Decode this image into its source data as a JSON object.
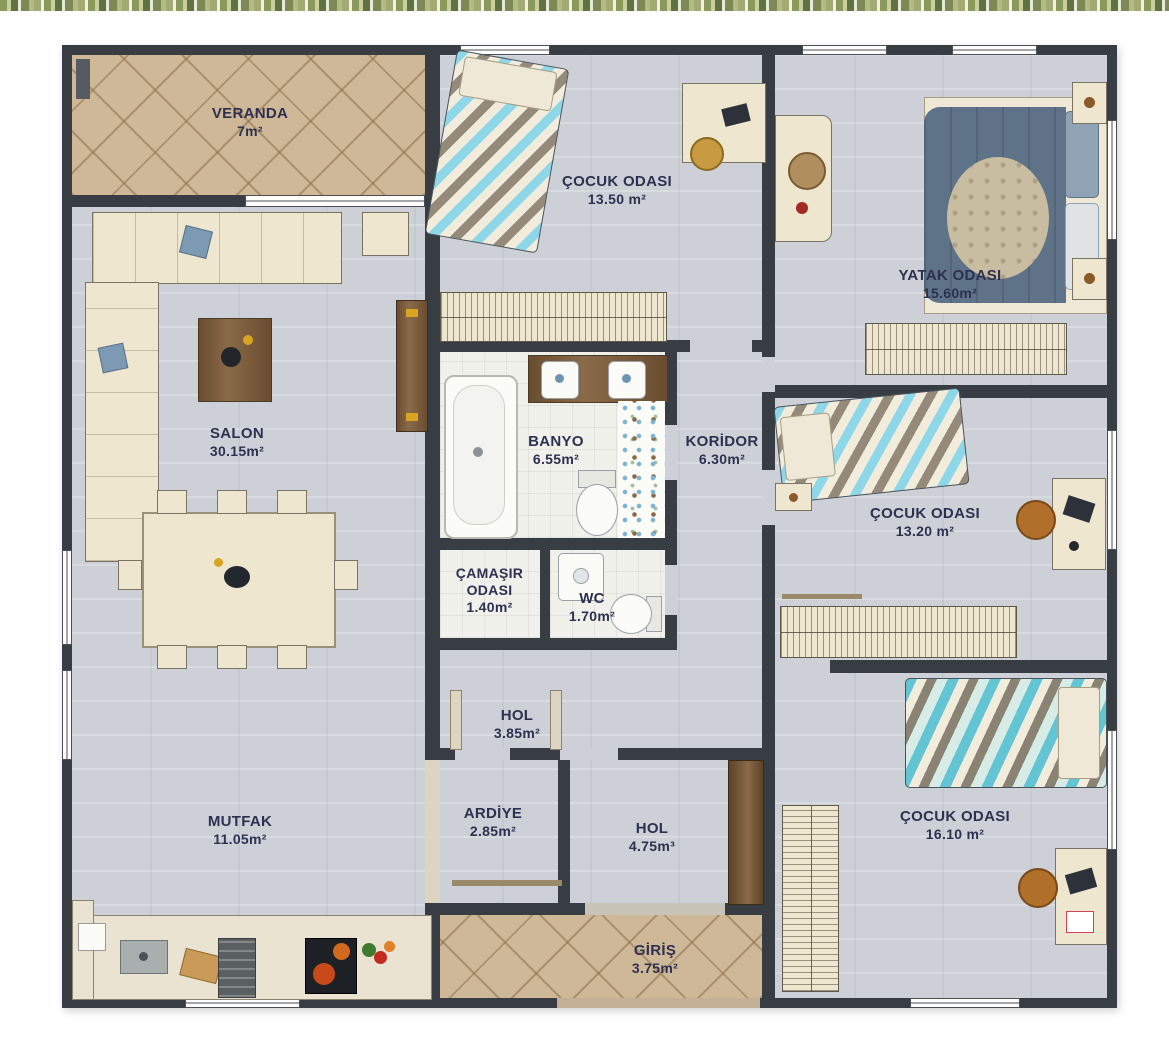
{
  "plan": {
    "type": "apartment-floor-plan",
    "rooms": [
      {
        "key": "veranda",
        "name": "VERANDA",
        "area": "7m²"
      },
      {
        "key": "cocuk-odasi-1",
        "name": "ÇOCUK ODASI",
        "area": "13.50 m²"
      },
      {
        "key": "yatak-odasi",
        "name": "YATAK ODASI",
        "area": "15.60m²"
      },
      {
        "key": "salon",
        "name": "SALON",
        "area": "30.15m²"
      },
      {
        "key": "banyo",
        "name": "BANYO",
        "area": "6.55m²"
      },
      {
        "key": "koridor",
        "name": "KORİDOR",
        "area": "6.30m²"
      },
      {
        "key": "cocuk-odasi-2",
        "name": "ÇOCUK ODASI",
        "area": "13.20 m²"
      },
      {
        "key": "camasir-odasi",
        "name": "ÇAMAŞIR ODASI",
        "area": "1.40m²"
      },
      {
        "key": "wc",
        "name": "WC",
        "area": "1.70m²"
      },
      {
        "key": "hol-1",
        "name": "HOL",
        "area": "3.85m²"
      },
      {
        "key": "mutfak",
        "name": "MUTFAK",
        "area": "11.05m²"
      },
      {
        "key": "ardiye",
        "name": "ARDİYE",
        "area": "2.85m²"
      },
      {
        "key": "hol-2",
        "name": "HOL",
        "area": "4.75m³"
      },
      {
        "key": "cocuk-odasi-3",
        "name": "ÇOCUK ODASI",
        "area": "16.10 m²"
      },
      {
        "key": "giris",
        "name": "GİRİŞ",
        "area": "3.75m²"
      }
    ],
    "colors": {
      "wall": "#383c43",
      "room_floor": "#cdd1d7",
      "tile_floor": "#cfb897",
      "bath_floor": "#f1f1ec",
      "furniture_cream": "#eee6cf",
      "wood_brown": "#7b5a3a",
      "master_bed_blue": "#5e7387",
      "chevron_blue": "#8ed7e9",
      "chevron_teal": "#63c4d4",
      "chair_orange": "#b06f2a",
      "label_text": "#2d3050"
    }
  }
}
